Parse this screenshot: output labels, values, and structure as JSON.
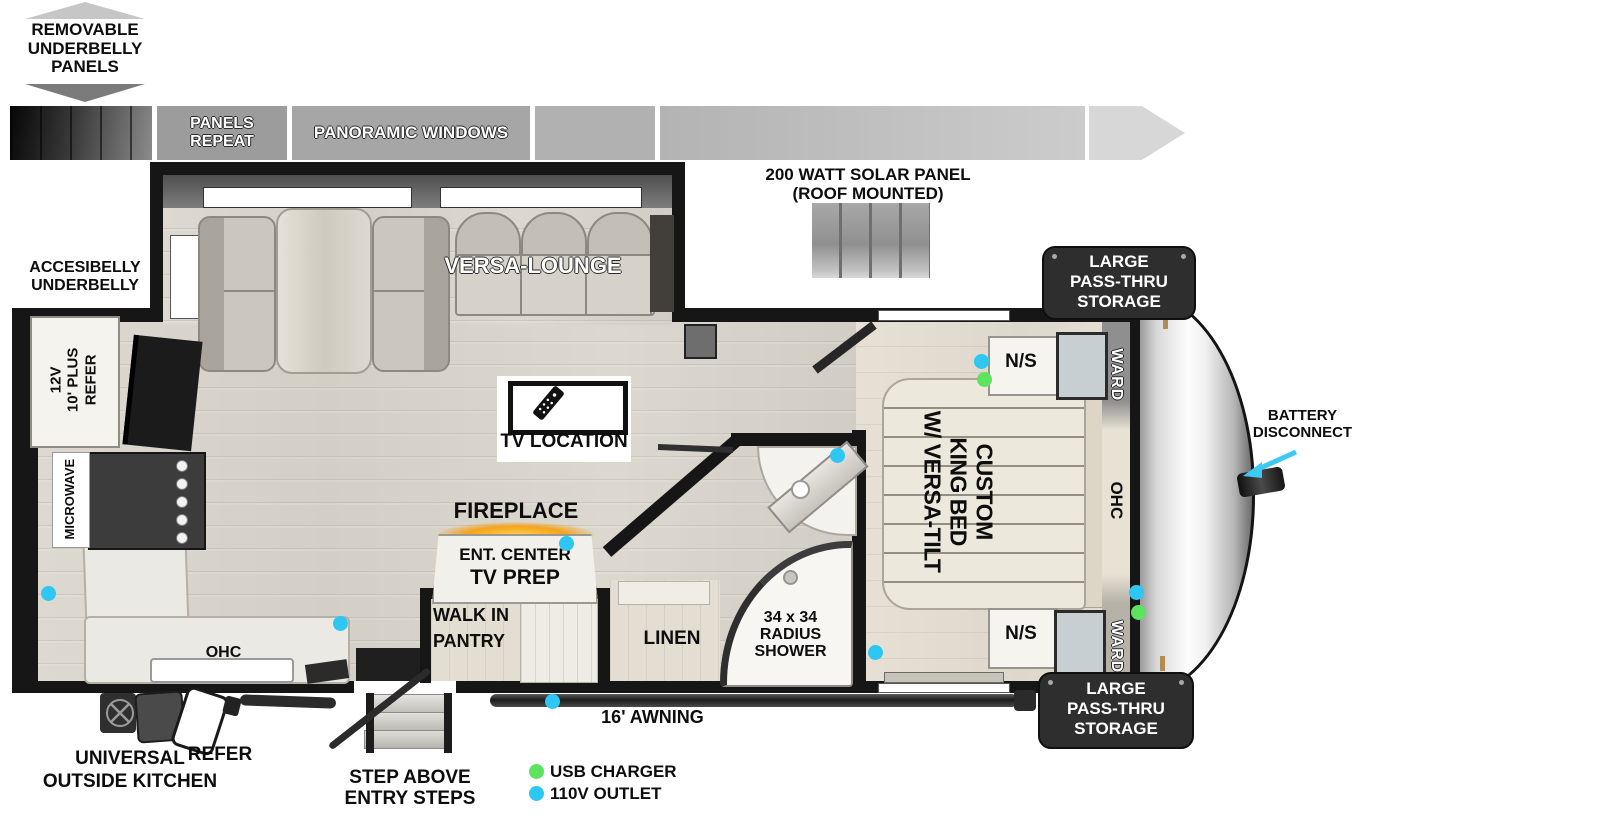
{
  "colors": {
    "outlet_blue": "#2ec6f2",
    "usb_green": "#5ee35e",
    "wall_black": "#161616",
    "badge_dark": "#2e2e2e",
    "fireplace_glow": "#f5a623",
    "battery_arrow_cyan": "#3cc9f2"
  },
  "callouts": {
    "removable_underbelly": [
      "REMOVABLE",
      "UNDERBELLY",
      "PANELS"
    ],
    "accesibelly_underbelly": [
      "ACCESIBELLY",
      "UNDERBELLY"
    ],
    "battery_disconnect": [
      "BATTERY",
      "DISCONNECT"
    ],
    "solar_panel": [
      "200 WATT SOLAR PANEL",
      "(ROOF MOUNTED)"
    ],
    "pass_thru_storage": [
      "LARGE",
      "PASS-THRU",
      "STORAGE"
    ]
  },
  "roof_strip": {
    "panels_repeat": [
      "PANELS",
      "REPEAT"
    ],
    "panoramic_windows": "PANORAMIC WINDOWS"
  },
  "rooms": {
    "versa_lounge": "VERSA-LOUNGE",
    "tv_location": "TV LOCATION",
    "fireplace": "FIREPLACE",
    "ent_center": "ENT. CENTER",
    "tv_prep": "TV PREP",
    "walk_in_pantry": [
      "WALK IN",
      "PANTRY"
    ],
    "linen": "LINEN",
    "radius_shower": [
      "34 x 34",
      "RADIUS",
      "SHOWER"
    ],
    "king_bed": [
      "CUSTOM",
      "KING BED",
      "W/ VERSA-TILT"
    ],
    "ns_top": "N/S",
    "ns_bottom": "N/S",
    "ward_top": "WARD",
    "ward_bottom": "WARD",
    "ohc_bedroom": "OHC",
    "ohc_kitchen": "OHC",
    "microwave": "MICROWAVE",
    "refer_12v": [
      "12V",
      "10' PLUS",
      "REFER"
    ]
  },
  "exterior": {
    "awning": "16' AWNING",
    "universal_outside_kitchen": [
      "UNIVERSAL",
      "OUTSIDE KITCHEN"
    ],
    "refer_flip": "REFER",
    "entry_steps": [
      "STEP ABOVE",
      "ENTRY STEPS"
    ]
  },
  "legend": {
    "usb_charger": "USB CHARGER",
    "outlet_110v": "110V OUTLET"
  }
}
